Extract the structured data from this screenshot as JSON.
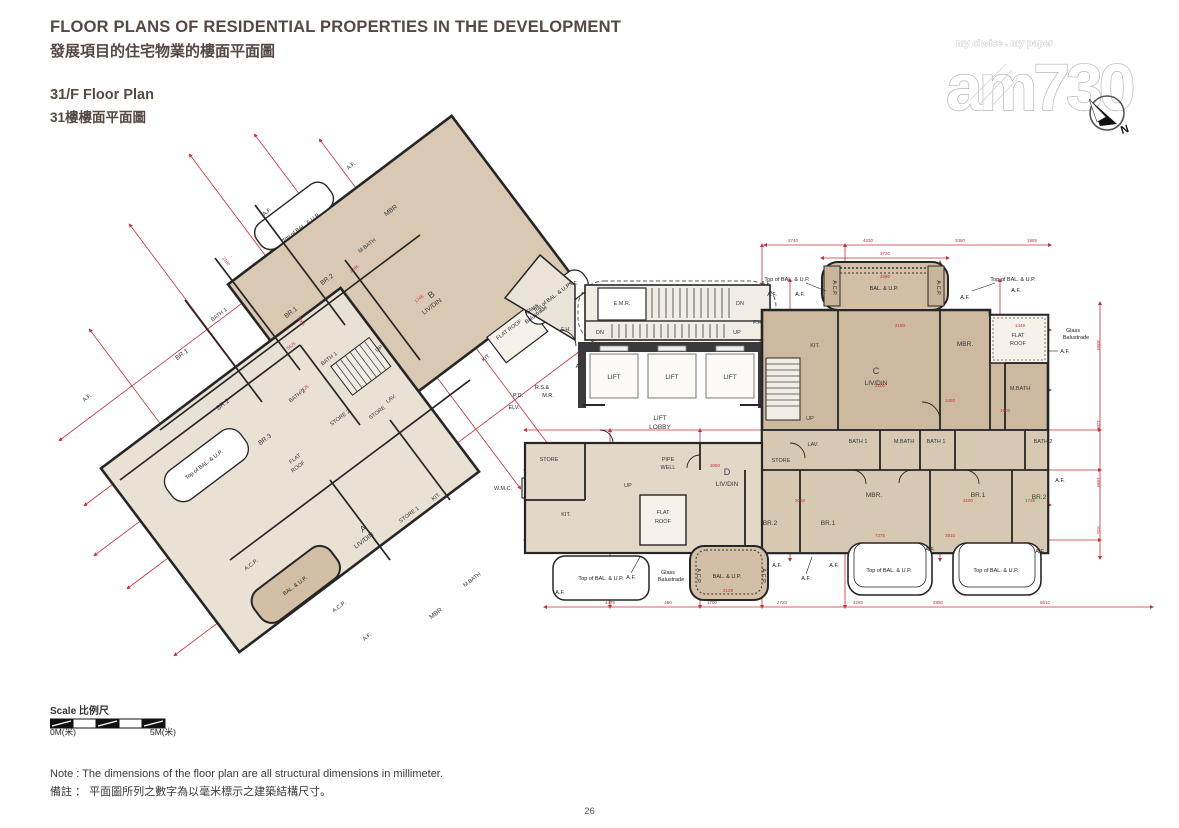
{
  "header": {
    "title_en": "FLOOR PLANS OF RESIDENTIAL PROPERTIES IN THE DEVELOPMENT",
    "title_zh": "發展項目的住宅物業的樓面平面圖",
    "floor_en": "31/F Floor Plan",
    "floor_zh": "31樓樓面平面圖"
  },
  "logo": {
    "tagline": "my choice . my paper",
    "name": "am730",
    "compass_n": "N"
  },
  "plan": {
    "flats": {
      "a": "A",
      "b": "B",
      "c": "C",
      "d": "D"
    },
    "rooms": {
      "livdin": "LIV/DIN",
      "mbr": "MBR.",
      "mbr_plain": "MBR",
      "br1": "BR.1",
      "br2": "BR.2",
      "br3": "BR.3",
      "bath1": "BATH 1",
      "bath2": "BATH 2",
      "mbath": "M.BATH",
      "kit": "KIT.",
      "store": "STORE",
      "store1": "STORE 1",
      "store2": "STORE 2",
      "lav": "LAV.",
      "flat": "FLAT",
      "roof": "ROOF",
      "flatroof": "FLAT ROOF",
      "lift": "LIFT",
      "lobby": "LOBBY",
      "pipe": "PIPE",
      "well": "WELL",
      "emr": "E.M.R.",
      "elv": "ELV.",
      "wmc": "W.M.C.",
      "up": "UP",
      "dn": "DN",
      "fh": "F.H.",
      "ad": "A.D.",
      "acp": "A.C.P.",
      "af": "A.F.",
      "balup": "BAL. & U.P.",
      "topbalup": "Top of BAL. & U.P.",
      "glass1": "Glass",
      "glass2": "Balustrade",
      "rs": "R.S.&",
      "mr": "M.R.",
      "pd": "P.D."
    },
    "dims": {
      "top": [
        "2740",
        "4330",
        "3380",
        "1985"
      ],
      "balcony": [
        "3720",
        "3280"
      ],
      "bottom": [
        "4475",
        "450",
        "1700",
        "2720",
        "4280",
        "2850",
        "6610"
      ],
      "right": [
        "3080",
        "1200",
        "1690",
        "915"
      ],
      "inner": [
        "2180",
        "1448",
        "2100",
        "2450",
        "1600",
        "7375",
        "3610",
        "3190",
        "1725",
        "2055",
        "3050",
        "2128"
      ],
      "wing": [
        "9125",
        "5625",
        "2100",
        "3065",
        "1205",
        "1745"
      ]
    }
  },
  "scalebar": {
    "label": "Scale 比例尺",
    "zero": "0M(米)",
    "five": "5M(米)"
  },
  "notes": {
    "en": "Note :  The dimensions of the floor plan are all structural dimensions in millimeter.",
    "zh": "備註 ：  平面圖所列之數字為以毫米標示之建築結構尺寸。"
  },
  "page": {
    "number": "26"
  }
}
